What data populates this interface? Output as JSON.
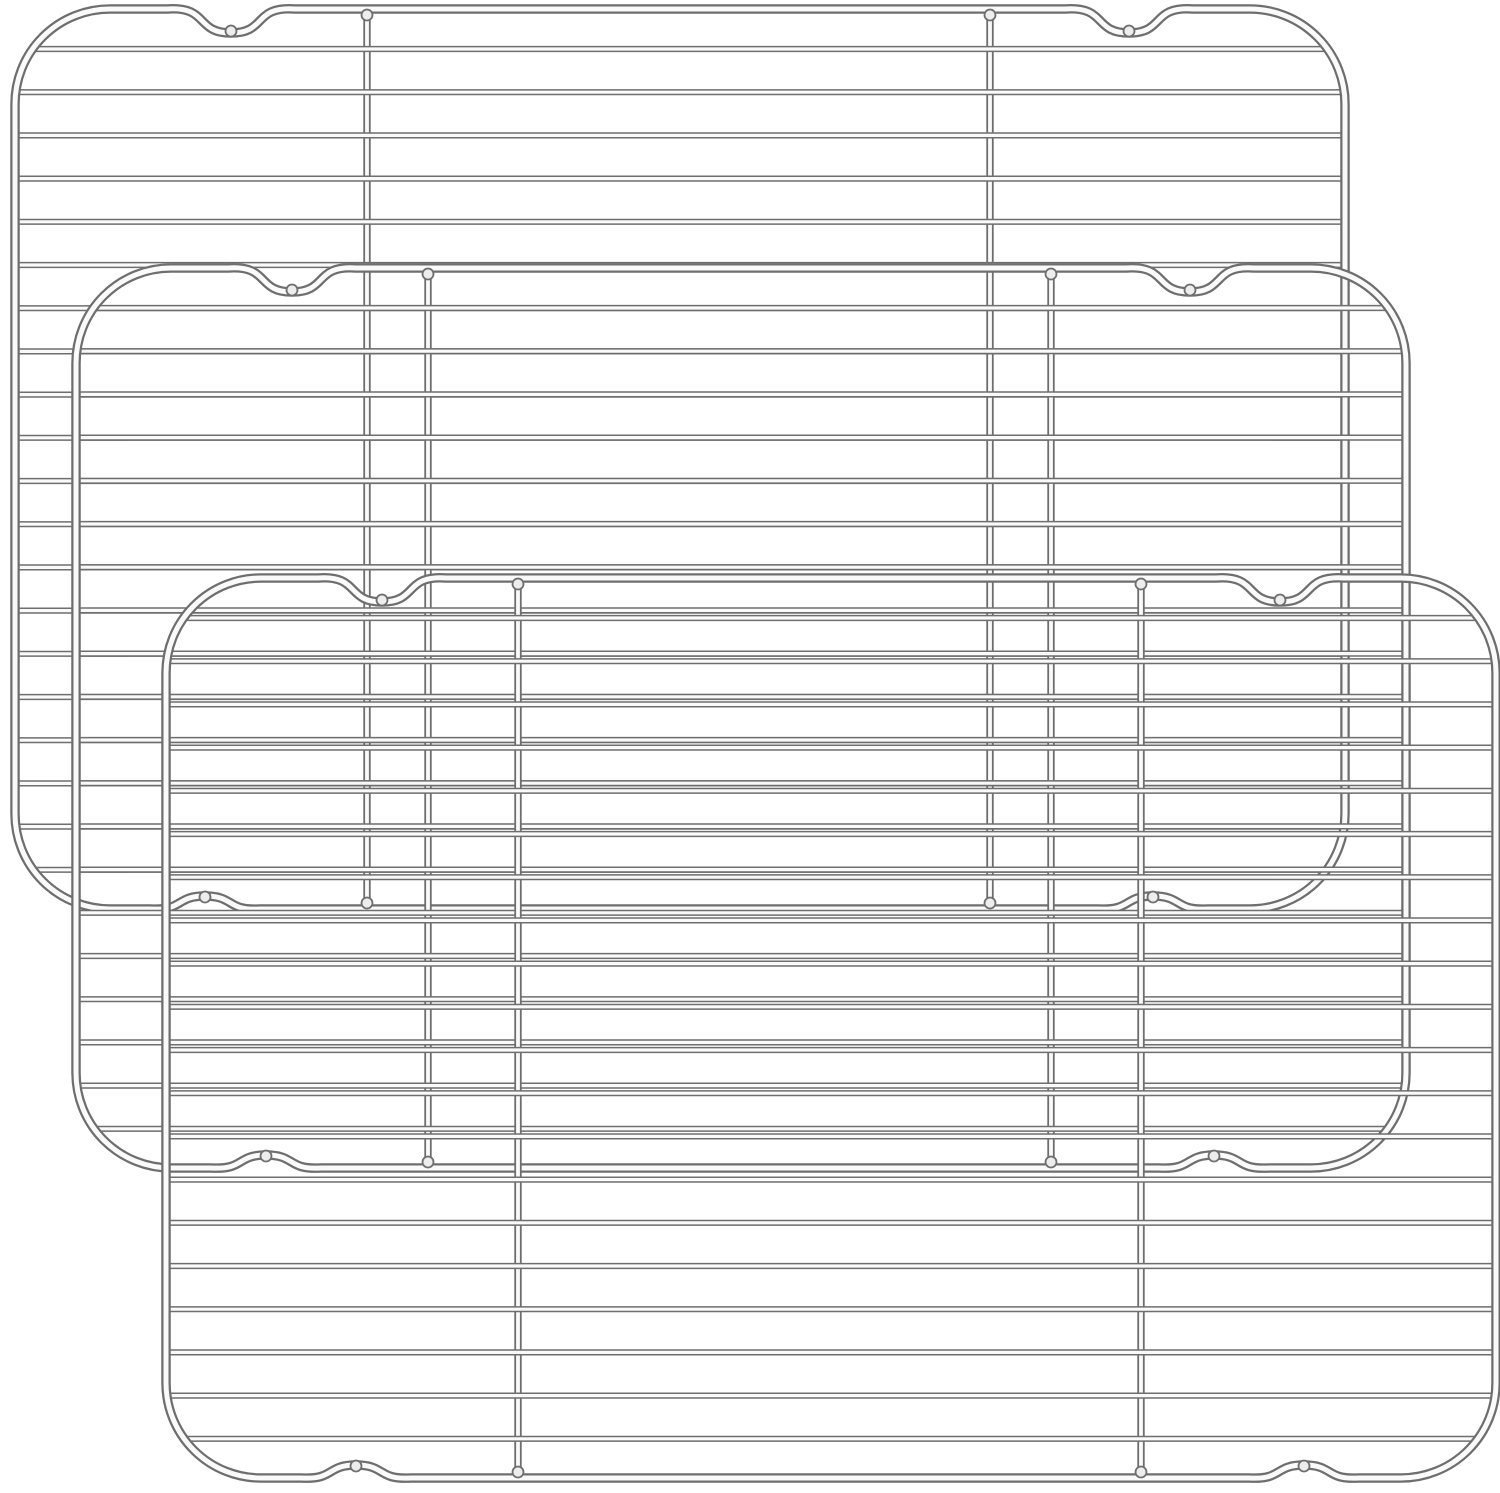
{
  "image": {
    "type": "product-photo",
    "subject": "Set of 3 stainless steel baking and cooling racks, top view, stacked with diagonal offset",
    "background_color": "#ffffff",
    "canvas_width": 1500,
    "canvas_height": 1493
  },
  "style": {
    "metal_edge_color": "#6e6e6e",
    "metal_highlight_color": "#fafafa",
    "frame_edge_width": 9.5,
    "frame_highlight_width": 5,
    "bar_edge_width": 7.4,
    "bar_highlight_width": 3.8,
    "wire_edge_width": 6.2,
    "wire_highlight_width": 3.2,
    "weld_fill_color": "#ededed",
    "weld_edge_width": 1.8,
    "weld_radius": 5.5
  },
  "rack": {
    "width": 1330,
    "height": 900,
    "corner_radius": 95,
    "wire_count": 20,
    "wire_start_offset": 40,
    "wire_spacing": 43.2,
    "wire_end_inset": 2,
    "support_bar_positions": [
      352,
      975
    ],
    "top_notches": {
      "centers": [
        216,
        1114
      ],
      "half_width": 64,
      "depth": 24,
      "shoulder_lift": 3
    },
    "bottom_notches": {
      "centers": [
        190,
        1138
      ],
      "half_width": 55,
      "depth": 13,
      "shoulder_lift": 2
    }
  },
  "racks": [
    {
      "id": "rack-back",
      "x": 15,
      "y": 9
    },
    {
      "id": "rack-middle",
      "x": 76,
      "y": 268
    },
    {
      "id": "rack-front",
      "x": 166,
      "y": 578
    }
  ]
}
